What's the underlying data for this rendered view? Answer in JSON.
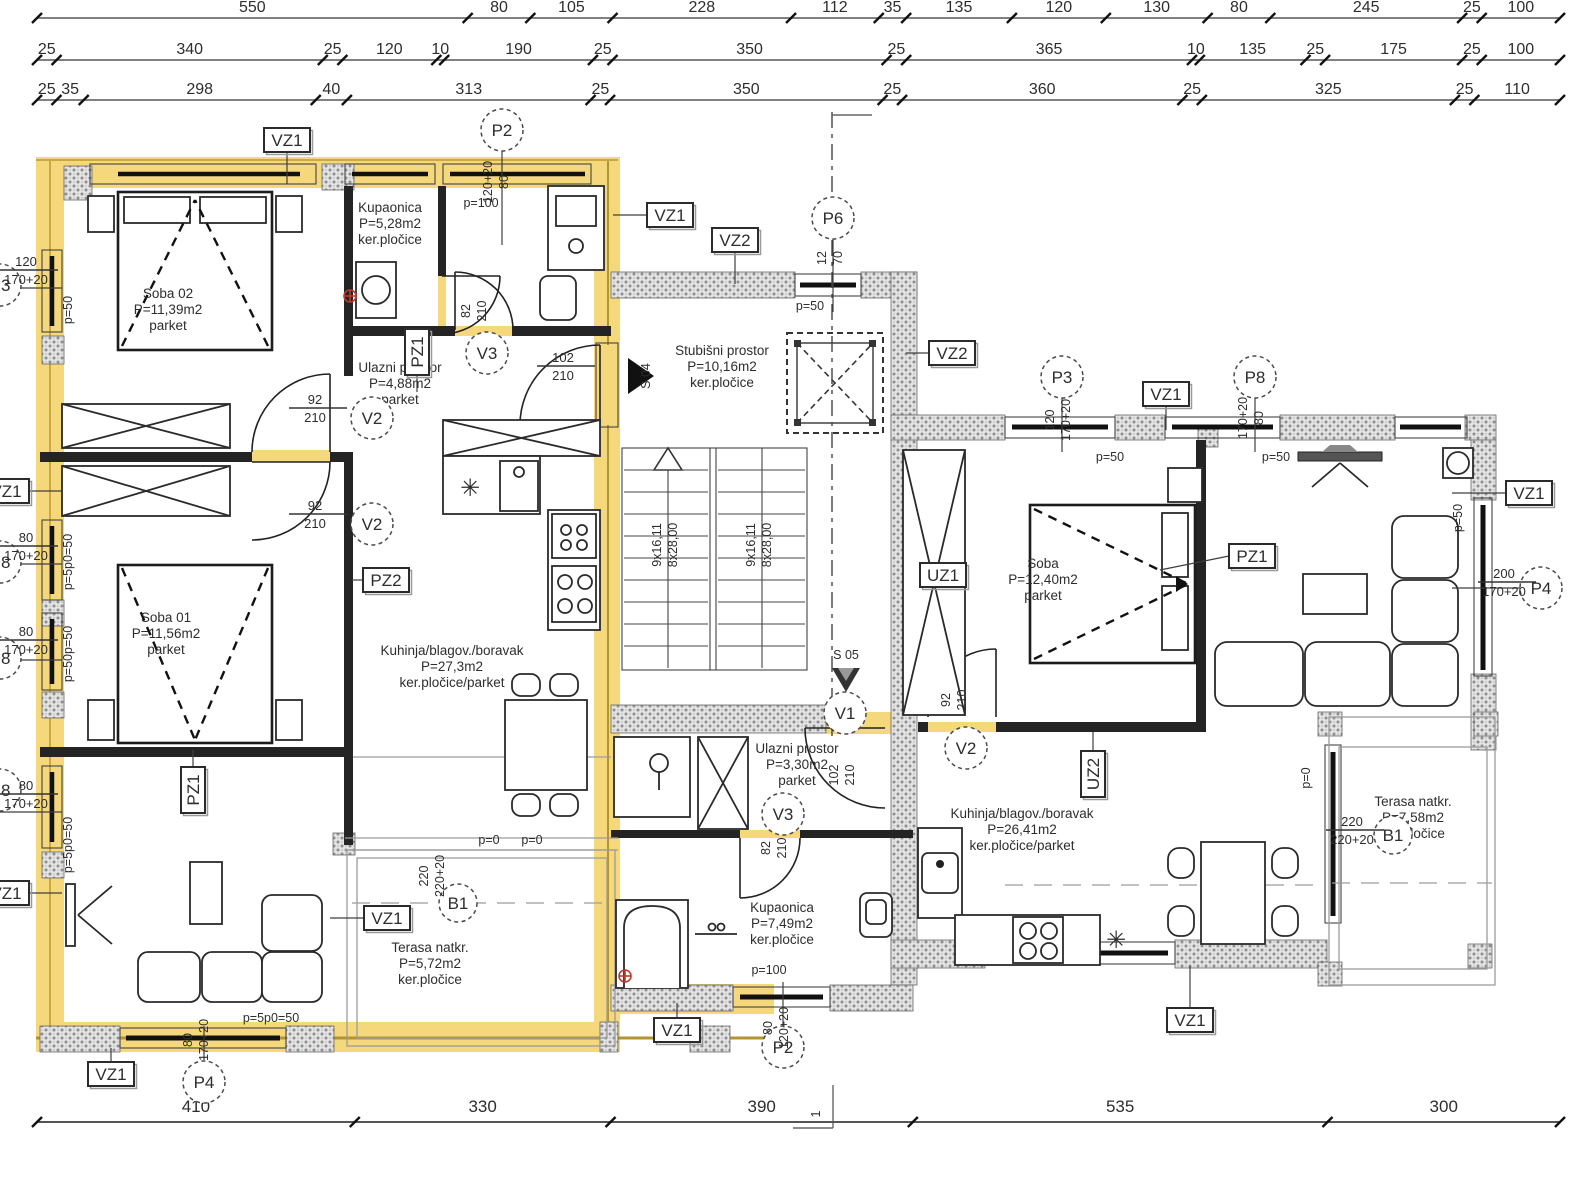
{
  "plan": {
    "colors": {
      "highlight": "#f6d87c",
      "highlight_core": "#b3952f",
      "wall": "#242424",
      "hatch_dot": "#909090",
      "red_symbol": "#c0392b",
      "text": "#2d2d2d"
    },
    "dims": {
      "top_rows": [
        {
          "y": 12,
          "values": [
            "550",
            "80",
            "105",
            "228",
            "112",
            "35",
            "135",
            "120",
            "130",
            "80",
            "245",
            "25",
            "100"
          ]
        },
        {
          "y": 54,
          "values": [
            "25",
            "340",
            "25",
            "120",
            "10",
            "190",
            "25",
            "350",
            "25",
            "365",
            "10",
            "135",
            "25",
            "175",
            "25",
            "100"
          ]
        },
        {
          "y": 94,
          "values": [
            "25",
            "35",
            "298",
            "40",
            "313",
            "25",
            "350",
            "25",
            "360",
            "25",
            "325",
            "25",
            "110"
          ]
        }
      ],
      "bottom_row": {
        "textY": 1112,
        "lineY": 1122,
        "values": [
          "410",
          "330",
          "390",
          "535",
          "300"
        ]
      },
      "bottom_grid_mark": "1"
    },
    "rooms": [
      {
        "id": "soba02",
        "x": 168,
        "y": 298,
        "lines": [
          "Soba 02",
          "P=11,39m2",
          "parket"
        ]
      },
      {
        "id": "kupaonica1",
        "x": 390,
        "y": 212,
        "lines": [
          "Kupaonica",
          "P=5,28m2",
          "ker.pločice"
        ]
      },
      {
        "id": "ulazni1",
        "x": 400,
        "y": 372,
        "lines": [
          "Ulazni prostor",
          "P=4,88m2",
          "parket"
        ]
      },
      {
        "id": "soba01",
        "x": 166,
        "y": 622,
        "lines": [
          "Soba 01",
          "P=11,56m2",
          "parket"
        ]
      },
      {
        "id": "kuhinja1",
        "x": 452,
        "y": 655,
        "lines": [
          "Kuhinja/blagov./boravak",
          "P=27,3m2",
          "ker.pločice/parket"
        ]
      },
      {
        "id": "stubisni",
        "x": 722,
        "y": 355,
        "lines": [
          "Stubišni prostor",
          "P=10,16m2",
          "ker.pločice"
        ]
      },
      {
        "id": "soba2",
        "x": 1043,
        "y": 568,
        "lines": [
          "Soba",
          "P=12,40m2",
          "parket"
        ]
      },
      {
        "id": "ulazni2",
        "x": 797,
        "y": 753,
        "lines": [
          "Ulazni prostor",
          "P=3,30m2",
          "parket"
        ]
      },
      {
        "id": "kupaonica2",
        "x": 782,
        "y": 912,
        "lines": [
          "Kupaonica",
          "P=7,49m2",
          "ker.pločice"
        ]
      },
      {
        "id": "kuhinja2",
        "x": 1022,
        "y": 818,
        "lines": [
          "Kuhinja/blagov./boravak",
          "P=26,41m2",
          "ker.pločice/parket"
        ]
      },
      {
        "id": "terasa1",
        "x": 430,
        "y": 952,
        "lines": [
          "Terasa natkr.",
          "P=5,72m2",
          "ker.pločice"
        ]
      },
      {
        "id": "terasa2",
        "x": 1413,
        "y": 806,
        "lines": [
          "Terasa natkr.",
          "P=7,58m2",
          "ker.pločice"
        ]
      }
    ],
    "markers": [
      {
        "t": "VZ1",
        "x": 287,
        "y": 140
      },
      {
        "t": "VZ1",
        "x": 670,
        "y": 215
      },
      {
        "t": "VZ2",
        "x": 735,
        "y": 240
      },
      {
        "t": "VZ2",
        "x": 952,
        "y": 353
      },
      {
        "t": "VZ1",
        "x": 1166,
        "y": 394
      },
      {
        "t": "VZ1",
        "x": 1529,
        "y": 493
      },
      {
        "t": "VZ1",
        "x": 387,
        "y": 918
      },
      {
        "t": "VZ1",
        "x": 111,
        "y": 1074
      },
      {
        "t": "VZ1",
        "x": 677,
        "y": 1030
      },
      {
        "t": "VZ1",
        "x": 1190,
        "y": 1020
      },
      {
        "t": "PZ2",
        "x": 386,
        "y": 580
      },
      {
        "t": "PZ1",
        "x": 1252,
        "y": 556
      },
      {
        "t": "UZ1",
        "x": 943,
        "y": 575
      },
      {
        "t": "UZ2",
        "x": 1093,
        "y": 774,
        "rot": 1
      },
      {
        "t": "PZ1",
        "x": 417,
        "y": 352,
        "rot": 1
      },
      {
        "t": "PZ1",
        "x": 193,
        "y": 790,
        "rot": 1
      },
      {
        "t": "VZ1",
        "x": 6,
        "y": 491
      },
      {
        "t": "VZ1",
        "x": 6,
        "y": 893
      }
    ],
    "circles": [
      {
        "t": "P2",
        "x": 502,
        "y": 130
      },
      {
        "t": "P6",
        "x": 833,
        "y": 218
      },
      {
        "t": "P3",
        "x": 1062,
        "y": 377
      },
      {
        "t": "P8",
        "x": 1255,
        "y": 377
      },
      {
        "t": "P4",
        "x": 1541,
        "y": 588
      },
      {
        "t": "V2",
        "x": 372,
        "y": 418
      },
      {
        "t": "V2",
        "x": 372,
        "y": 524
      },
      {
        "t": "V3",
        "x": 487,
        "y": 353
      },
      {
        "t": "V1",
        "x": 845,
        "y": 713
      },
      {
        "t": "V2",
        "x": 966,
        "y": 748
      },
      {
        "t": "V3",
        "x": 783,
        "y": 814
      },
      {
        "t": "B1",
        "x": 458,
        "y": 903,
        "r": 19
      },
      {
        "t": "B1",
        "x": 1393,
        "y": 835,
        "r": 19
      },
      {
        "t": "P2",
        "x": 783,
        "y": 1047
      },
      {
        "t": "P4",
        "x": 204,
        "y": 1082
      },
      {
        "t": "P3",
        "x": 0,
        "y": 285
      },
      {
        "t": "P8",
        "x": 0,
        "y": 562
      },
      {
        "t": "P8",
        "x": 0,
        "y": 658
      },
      {
        "t": "P8",
        "x": 0,
        "y": 790
      }
    ],
    "stacked_dims": [
      {
        "a": "92",
        "b": "210",
        "x": 315,
        "y": 404
      },
      {
        "a": "92",
        "b": "210",
        "x": 315,
        "y": 510
      },
      {
        "a": "102",
        "b": "210",
        "x": 563,
        "y": 362
      },
      {
        "a": "200",
        "b": "170+20",
        "x": 1504,
        "y": 578
      },
      {
        "a": "220",
        "b": "220+20",
        "x": 1352,
        "y": 826
      },
      {
        "a": "120",
        "b": "170+20",
        "x": 26,
        "y": 266
      },
      {
        "a": "80",
        "b": "170+20",
        "x": 26,
        "y": 542
      },
      {
        "a": "80",
        "b": "170+20",
        "x": 26,
        "y": 636
      },
      {
        "a": "80",
        "b": "170+20",
        "x": 26,
        "y": 790
      }
    ],
    "rotated_dims": [
      {
        "a": "120+20",
        "b": "80",
        "x": 492,
        "y": 182
      },
      {
        "a": "12",
        "b": "70",
        "x": 826,
        "y": 258
      },
      {
        "a": "120",
        "b": "170+20",
        "x": 1054,
        "y": 420
      },
      {
        "a": "170+20",
        "b": "80",
        "x": 1247,
        "y": 418
      },
      {
        "a": "82",
        "b": "210",
        "x": 470,
        "y": 311
      },
      {
        "a": "92",
        "b": "210",
        "x": 950,
        "y": 700
      },
      {
        "a": "102",
        "b": "210",
        "x": 838,
        "y": 775
      },
      {
        "a": "82",
        "b": "210",
        "x": 770,
        "y": 848
      },
      {
        "a": "80",
        "b": "120+20",
        "x": 772,
        "y": 1028
      },
      {
        "a": "80",
        "b": "170+20",
        "x": 192,
        "y": 1040
      },
      {
        "a": "220",
        "b": "220+20",
        "x": 428,
        "y": 876
      },
      {
        "a": "9x16,11",
        "b": "8x28,00",
        "x": 661,
        "y": 545
      },
      {
        "a": "9x16,11",
        "b": "8x28,00",
        "x": 755,
        "y": 545
      }
    ],
    "rot_singles": [
      {
        "t": "S 04",
        "x": 650,
        "y": 376
      },
      {
        "t": "1",
        "x": 820,
        "y": 1114
      },
      {
        "t": "p=50",
        "x": 72,
        "y": 310
      },
      {
        "t": "p=5p0=50",
        "x": 72,
        "y": 562
      },
      {
        "t": "p=50p=50",
        "x": 72,
        "y": 654
      },
      {
        "t": "p=5p0=50",
        "x": 72,
        "y": 845
      },
      {
        "t": "p=50",
        "x": 1462,
        "y": 518
      },
      {
        "t": "p=0",
        "x": 1310,
        "y": 778
      }
    ],
    "texts": [
      {
        "t": "p=100",
        "x": 481,
        "y": 207
      },
      {
        "t": "p=50",
        "x": 810,
        "y": 310
      },
      {
        "t": "p=50",
        "x": 1110,
        "y": 461
      },
      {
        "t": "p=50",
        "x": 1276,
        "y": 461
      },
      {
        "t": "p=0",
        "x": 489,
        "y": 844
      },
      {
        "t": "p=0",
        "x": 532,
        "y": 844
      },
      {
        "t": "p=100",
        "x": 769,
        "y": 974
      },
      {
        "t": "p=5p0=50",
        "x": 271,
        "y": 1022
      },
      {
        "t": "S 05",
        "x": 846,
        "y": 659
      },
      {
        "t": "✳",
        "x": 470,
        "y": 496,
        "fs": 24
      },
      {
        "t": "✳",
        "x": 1116,
        "y": 948,
        "fs": 24
      }
    ]
  }
}
